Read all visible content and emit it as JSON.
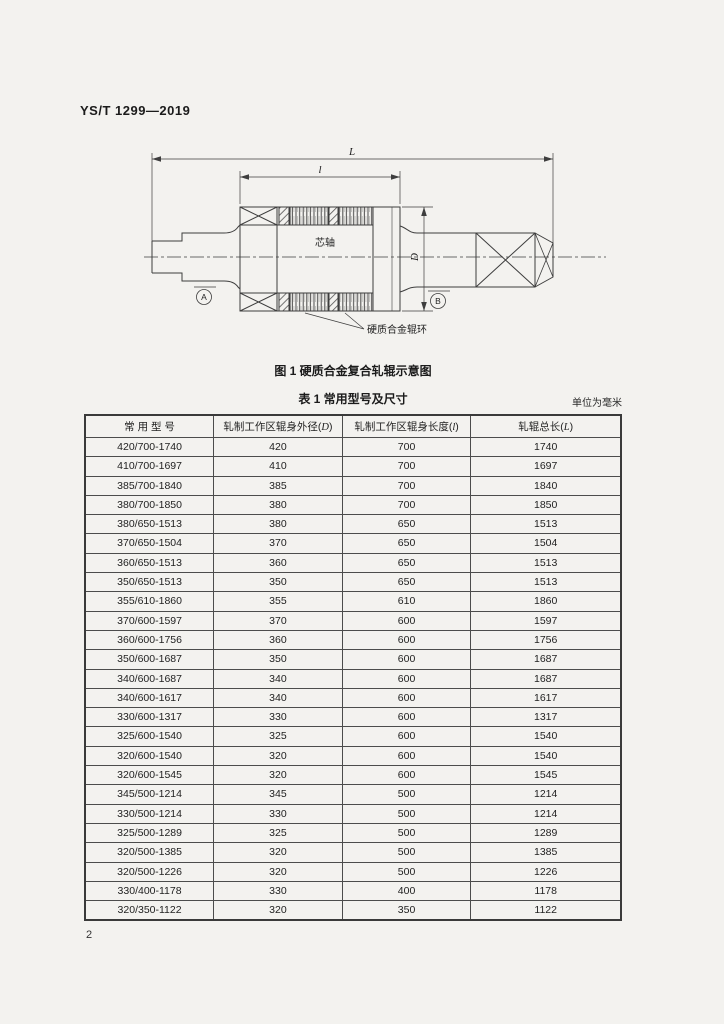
{
  "header": {
    "standard_code": "YS/T 1299—2019"
  },
  "figure": {
    "caption": "图 1  硬质合金复合轧辊示意图",
    "labels": {
      "overall_length": "L",
      "working_length": "l",
      "diameter": "D",
      "core_shaft": "芯轴",
      "carbide_ring": "硬质合金辊环",
      "datum_a": "A",
      "datum_b": "B"
    }
  },
  "table": {
    "caption": "表 1  常用型号及尺寸",
    "unit_note": "单位为毫米",
    "columns": [
      {
        "label": "常 用 型 号",
        "symbol": ""
      },
      {
        "label": "轧制工作区辊身外径",
        "symbol": "D"
      },
      {
        "label": "轧制工作区辊身长度",
        "symbol": "l"
      },
      {
        "label": "轧辊总长",
        "symbol": "L"
      }
    ],
    "rows": [
      [
        "420/700-1740",
        "420",
        "700",
        "1740"
      ],
      [
        "410/700-1697",
        "410",
        "700",
        "1697"
      ],
      [
        "385/700-1840",
        "385",
        "700",
        "1840"
      ],
      [
        "380/700-1850",
        "380",
        "700",
        "1850"
      ],
      [
        "380/650-1513",
        "380",
        "650",
        "1513"
      ],
      [
        "370/650-1504",
        "370",
        "650",
        "1504"
      ],
      [
        "360/650-1513",
        "360",
        "650",
        "1513"
      ],
      [
        "350/650-1513",
        "350",
        "650",
        "1513"
      ],
      [
        "355/610-1860",
        "355",
        "610",
        "1860"
      ],
      [
        "370/600-1597",
        "370",
        "600",
        "1597"
      ],
      [
        "360/600-1756",
        "360",
        "600",
        "1756"
      ],
      [
        "350/600-1687",
        "350",
        "600",
        "1687"
      ],
      [
        "340/600-1687",
        "340",
        "600",
        "1687"
      ],
      [
        "340/600-1617",
        "340",
        "600",
        "1617"
      ],
      [
        "330/600-1317",
        "330",
        "600",
        "1317"
      ],
      [
        "325/600-1540",
        "325",
        "600",
        "1540"
      ],
      [
        "320/600-1540",
        "320",
        "600",
        "1540"
      ],
      [
        "320/600-1545",
        "320",
        "600",
        "1545"
      ],
      [
        "345/500-1214",
        "345",
        "500",
        "1214"
      ],
      [
        "330/500-1214",
        "330",
        "500",
        "1214"
      ],
      [
        "325/500-1289",
        "325",
        "500",
        "1289"
      ],
      [
        "320/500-1385",
        "320",
        "500",
        "1385"
      ],
      [
        "320/500-1226",
        "320",
        "500",
        "1226"
      ],
      [
        "330/400-1178",
        "330",
        "400",
        "1178"
      ],
      [
        "320/350-1122",
        "320",
        "350",
        "1122"
      ]
    ]
  },
  "footer": {
    "page_number": "2"
  }
}
